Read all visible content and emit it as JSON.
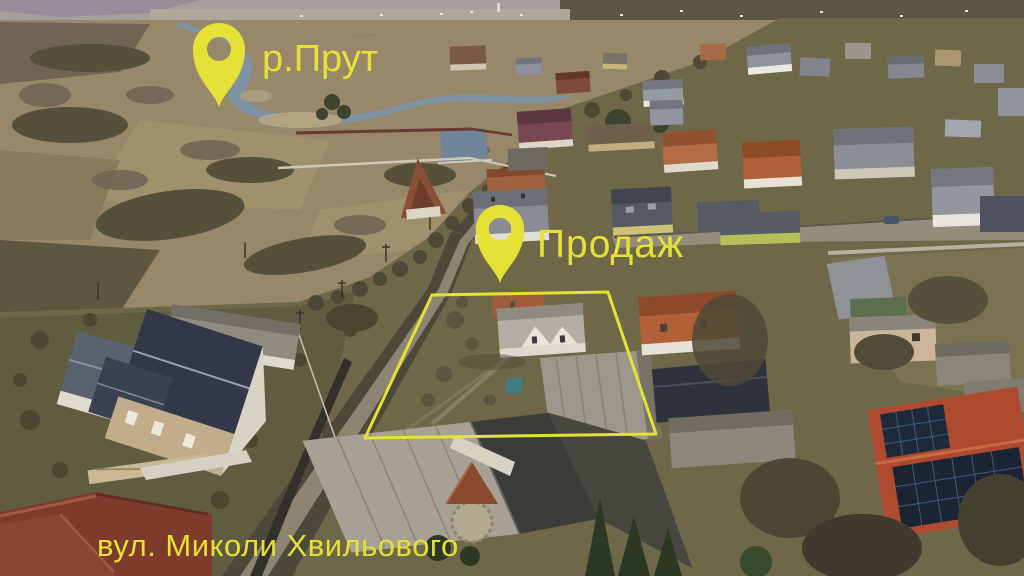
{
  "annotations": {
    "highlight_color": "#e6e136",
    "river_pin": {
      "icon": "map-pin",
      "label": "р.Прут"
    },
    "sale_pin": {
      "icon": "map-pin",
      "label": "Продаж"
    },
    "street_label": "вул. Миколи Хвильового",
    "property_boundary": {
      "shape": "quadrilateral",
      "stroke_color": "#e6e136"
    }
  }
}
